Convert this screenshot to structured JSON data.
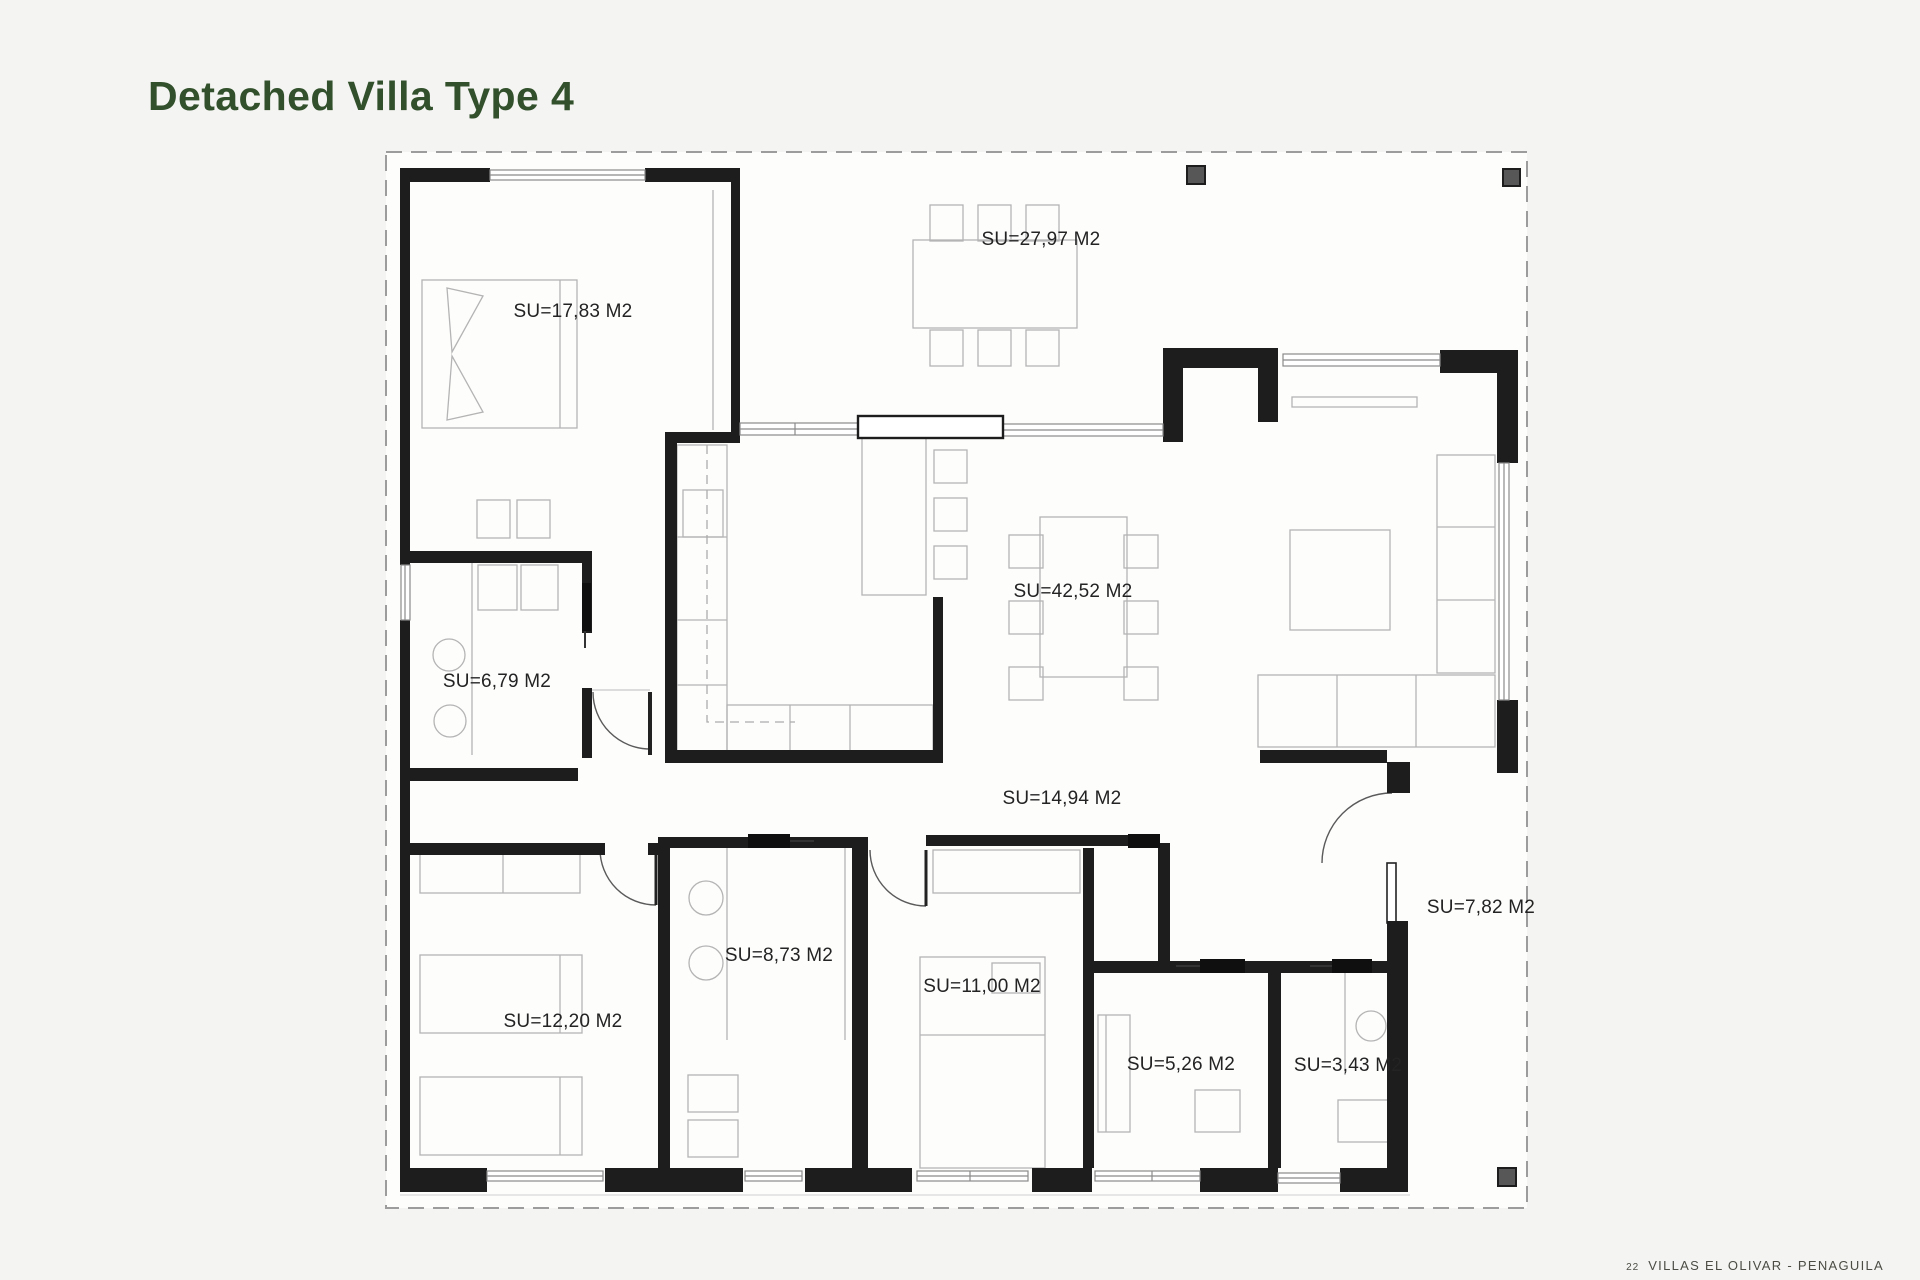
{
  "page": {
    "title": "Detached Villa Type 4",
    "footer": {
      "number": "22",
      "text": "VILLAS EL OLIVAR - PENAGUILA"
    }
  },
  "plan": {
    "drawing_type": "floor-plan",
    "area_unit": "M2",
    "rooms": [
      {
        "name": "main-bedroom",
        "label": "SU=17,83 M2",
        "area_m2": "17,83"
      },
      {
        "name": "terrace",
        "label": "SU=27,97 M2",
        "area_m2": "27,97"
      },
      {
        "name": "living-dining",
        "label": "SU=42,52 M2",
        "area_m2": "42,52"
      },
      {
        "name": "laundry",
        "label": "SU=6,79 M2",
        "area_m2": "6,79"
      },
      {
        "name": "hallway",
        "label": "SU=14,94 M2",
        "area_m2": "14,94"
      },
      {
        "name": "bathroom-1",
        "label": "SU=8,73 M2",
        "area_m2": "8,73"
      },
      {
        "name": "bedroom-2",
        "label": "SU=12,20 M2",
        "area_m2": "12,20"
      },
      {
        "name": "bedroom-3",
        "label": "SU=11,00 M2",
        "area_m2": "11,00"
      },
      {
        "name": "bathroom-2",
        "label": "SU=5,26 M2",
        "area_m2": "5,26"
      },
      {
        "name": "toilet",
        "label": "SU=3,43 M2",
        "area_m2": "3,43"
      },
      {
        "name": "side-porch",
        "label": "SU=7,82 M2",
        "area_m2": "7,82"
      }
    ],
    "colors": {
      "title": "#31502b",
      "wall": "#1d1d1d",
      "boundary": "#9c9c9c",
      "furniture_line": "#b4b4b4",
      "window_line": "#8a8a8a",
      "door_arc": "#5a5a5a",
      "pillar": "#575757",
      "label_text": "#232323",
      "footer_text": "#4c4c45",
      "background": "#f4f4f2"
    }
  }
}
